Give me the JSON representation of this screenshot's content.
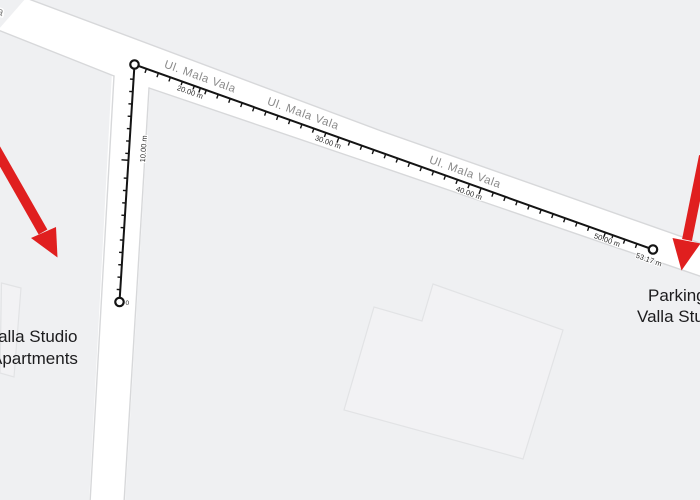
{
  "streets": {
    "labels": [
      "Ul. Mala Vala",
      "Ul. Mala Vala",
      "Ul. Mala Vala"
    ],
    "partial_edge_label": "a"
  },
  "ruler": {
    "origin_label": "0",
    "vertical_segment_label": "10.00 m",
    "marks": [
      "20.00 m",
      "30.00 m",
      "40.00 m",
      "50.00 m"
    ],
    "total_label": "53.17 m"
  },
  "places": {
    "left": {
      "line1": "Valla Studio",
      "line2": "Apartments"
    },
    "right": {
      "line1": "Parking",
      "line2": "Valla Studio"
    }
  },
  "colors": {
    "background": "#eff0f2",
    "road_fill": "#ffffff",
    "measure": "#141414",
    "street_label": "#8a8a8a",
    "arrow_red": "#e01f1f"
  }
}
